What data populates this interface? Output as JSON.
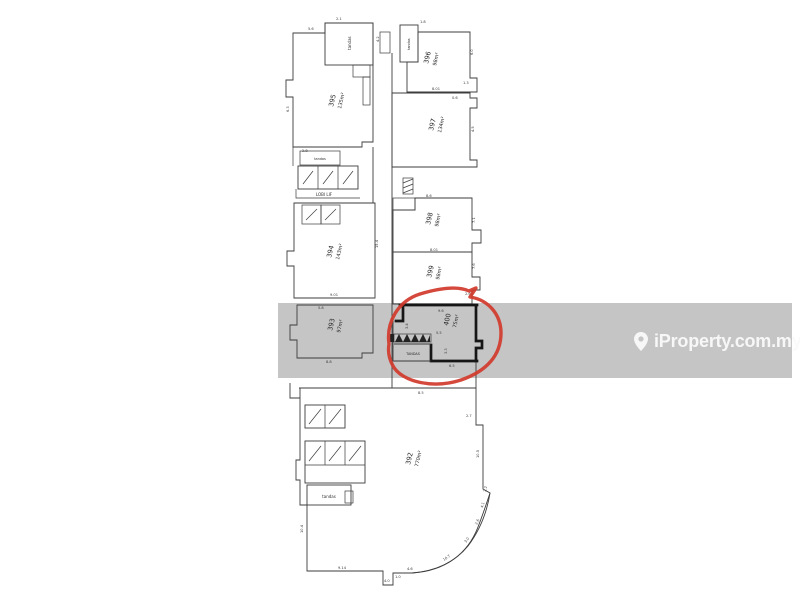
{
  "source": {
    "watermark": "iProperty.com.my"
  },
  "colors": {
    "background": "#ffffff",
    "highlight_band": "#c5c5c5",
    "highlight_circle": "#d13a2c",
    "plan_line": "#3c3c3c",
    "bold_unit_outline": "#161616",
    "watermark_text": "#f7f7f7"
  },
  "floorplan": {
    "units": [
      {
        "number": "395",
        "area": "135m²"
      },
      {
        "number": "396",
        "area": "98m²"
      },
      {
        "number": "397",
        "area": "134m²"
      },
      {
        "number": "394",
        "area": "143m²"
      },
      {
        "number": "398",
        "area": "98m²"
      },
      {
        "number": "399",
        "area": "98m²"
      },
      {
        "number": "393",
        "area": "97m²"
      },
      {
        "number": "400",
        "area": "75m²",
        "highlighted": true
      },
      {
        "number": "392",
        "area": "770m²"
      }
    ],
    "rooms": {
      "toilet_top_1": "tandas",
      "toilet_top_2": "tandas",
      "lobby_toilet": "tandas",
      "lift_lobby": "LOBI LIF",
      "lower_toilet": "tandas",
      "unit400_toilet": "TANDAS"
    },
    "dims": [
      "5.6",
      "2.1",
      "1.8",
      "6.0",
      "8.01",
      "0.6",
      "1.3",
      "4.5",
      "6.3",
      "2.8",
      "4.2",
      "9.01",
      "15.4",
      "8.6",
      "7.1",
      "8.01",
      "7.6",
      "2.6",
      "9.6",
      "3.4",
      "5.5",
      "3.3",
      "6.5",
      "5.8",
      "8.8",
      "10.4",
      "9.14",
      "4.0",
      "1.0",
      "4.6",
      "10.7",
      "3.0",
      "2.6",
      "4.1",
      "2.2",
      "10.5",
      "2.7",
      "8.5"
    ]
  }
}
